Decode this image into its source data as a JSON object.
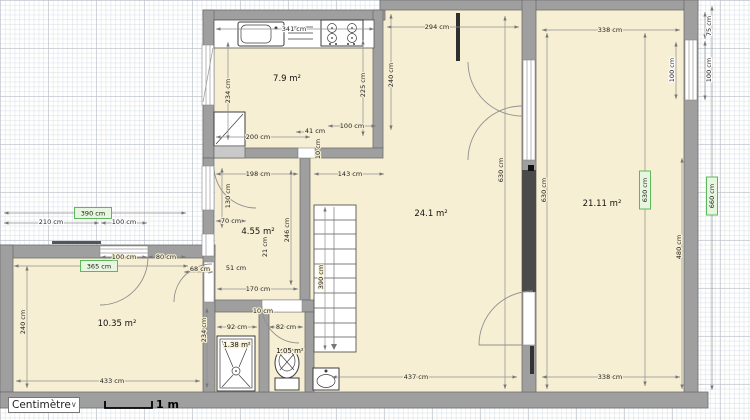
{
  "toolbar": {
    "units": "Centimètre",
    "scale": "1 m"
  },
  "rooms": {
    "kitchen": "7.9 m²",
    "living": "24.1 m²",
    "bedroom_right": "21.11 m²",
    "hall": "4.55 m²",
    "bedroom_left": "10.35 m²",
    "shower_room": "1.38 m²",
    "wc": "1.05 m²"
  },
  "dimensions": {
    "kitchen_width": "341 cm",
    "living_top_width": "294 cm",
    "bedroom_top_width": "338 cm",
    "kitchen_left_height": "234 cm",
    "kitchen_right_height": "225 cm",
    "kitchen_outer_height": "240 cm",
    "kitchen_bottom": "200 cm",
    "kitchen_door": "41 cm",
    "kitchen_wall_thickness": "10 cm",
    "kitchen_opening": "100 cm",
    "hall_top_width": "198 cm",
    "stair_hall_width": "143 cm",
    "hall_door_height": "130 cm",
    "hall_door_width": "70 cm",
    "hall_height": "246 cm",
    "hall_small_a": "21 cm",
    "hall_small_b": "51 cm",
    "side_door_width": "68 cm",
    "hall_bottom_width": "170 cm",
    "bath_wall_thickness": "10 cm",
    "shower_room_width": "92 cm",
    "wc_width": "82 cm",
    "bath_left_height": "234 cm",
    "bedroom_left_height": "240 cm",
    "bedroom_left_bottom": "433 cm",
    "living_bottom": "437 cm",
    "bedroom_bottom": "338 cm",
    "stairs_length": "390 cm",
    "living_height_left": "630 cm",
    "bedroom_height_left": "630 cm",
    "bedroom_height_right": "630 cm",
    "outer_height_right": "660 cm",
    "bedroom_inner_height": "480 cm",
    "window_right_offset": "75 cm",
    "window_right_outer": "100 cm",
    "window_right_inner": "100 cm",
    "terrace_left": "210 cm",
    "terrace_window": "100 cm",
    "terrace_total": "390 cm",
    "left_door_width": "100 cm",
    "left_door_offset": "80 cm",
    "bedroom_left_top": "365 cm"
  },
  "colors": {
    "room_fill": "#f7efd3",
    "wall": "#9f9f9f",
    "selected_wall": "#4a4a4a",
    "dimension_highlight_bg": "#e7f6df",
    "dimension_highlight_border": "#5cb85c"
  }
}
